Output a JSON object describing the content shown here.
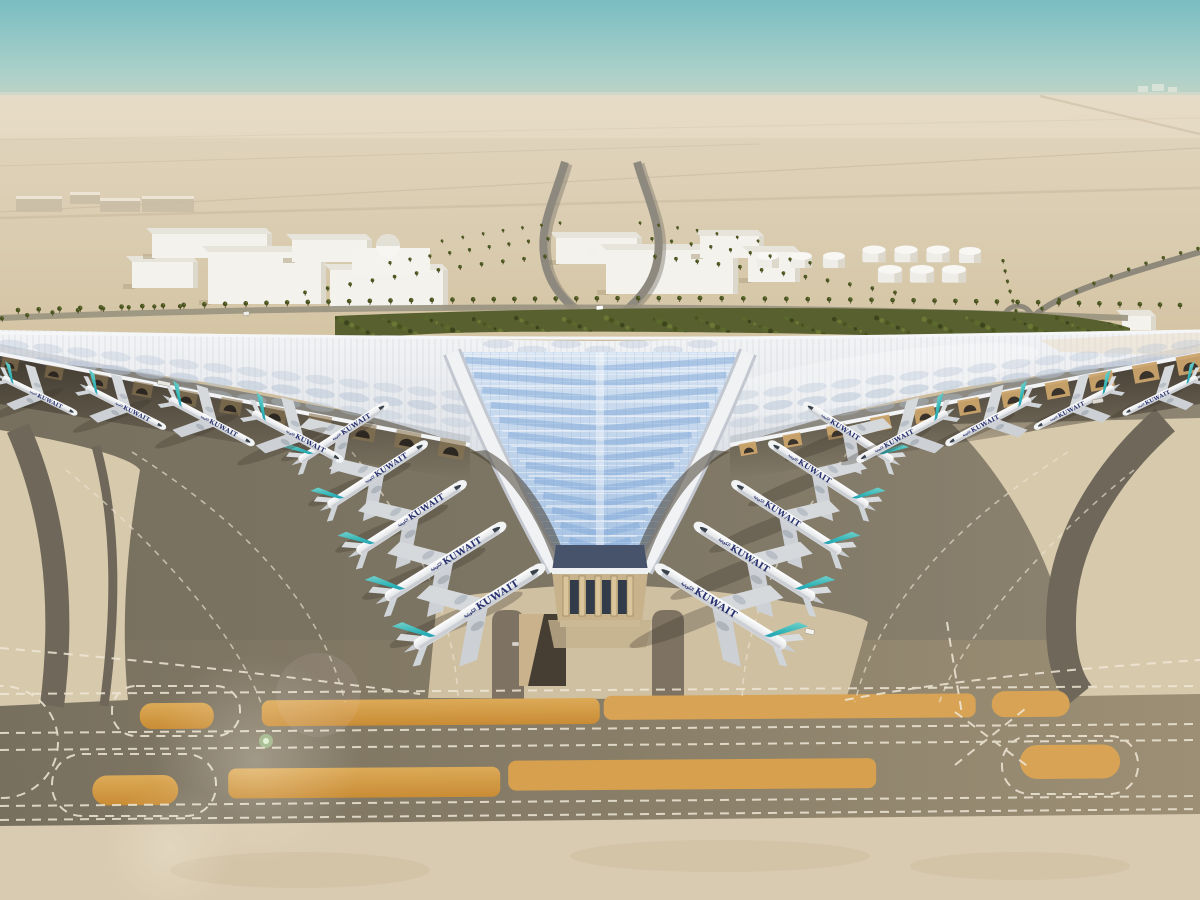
{
  "scene": {
    "title": "Aerial rendering of Kuwait International Airport trefoil terminal",
    "airline": "KUWAIT",
    "airline_arabic": "الكويتية",
    "colors": {
      "sky_top": "#79bdc2",
      "sky_haze": "#ded5c2",
      "desert": "#d5c5a6",
      "apron_dark": "#7b7363",
      "taxiway_paint_orange": "#d29843",
      "concrete_light": "#d8cab0",
      "roof_silver": "#e9ebee",
      "roof_glass_blue": "#aac6e2",
      "green_strip": "#57602e",
      "tail_teal": "#2fb4b4",
      "tail_blue": "#1b74b8",
      "airline_navy": "#26306e"
    },
    "counts": {
      "left_pier_aircraft": 5,
      "right_pier_aircraft": 5,
      "left_wing_aircraft": 4,
      "right_wing_aircraft": 4,
      "fuel_tanks": 10
    },
    "aircraft": [
      {
        "x": 344,
        "y": 432,
        "s": 0.64,
        "rot": -33,
        "m": 0
      },
      {
        "x": 378,
        "y": 474,
        "s": 0.71,
        "rot": -33,
        "m": 0
      },
      {
        "x": 412,
        "y": 517,
        "s": 0.78,
        "rot": -33,
        "m": 0
      },
      {
        "x": 446,
        "y": 561,
        "s": 0.85,
        "rot": -32,
        "m": 0
      },
      {
        "x": 480,
        "y": 606,
        "s": 0.92,
        "rot": -32,
        "m": 0
      },
      {
        "x": 848,
        "y": 432,
        "s": 0.64,
        "rot": 33,
        "m": 1
      },
      {
        "x": 818,
        "y": 474,
        "s": 0.71,
        "rot": 33,
        "m": 1
      },
      {
        "x": 786,
        "y": 517,
        "s": 0.78,
        "rot": 33,
        "m": 1
      },
      {
        "x": 754,
        "y": 561,
        "s": 0.85,
        "rot": 32,
        "m": 1
      },
      {
        "x": 720,
        "y": 606,
        "s": 0.92,
        "rot": 32,
        "m": 1
      },
      {
        "x": 40,
        "y": 396,
        "s": 0.5,
        "rot": 26,
        "m": 0
      },
      {
        "x": 126,
        "y": 408,
        "s": 0.54,
        "rot": 27,
        "m": 0
      },
      {
        "x": 212,
        "y": 422,
        "s": 0.58,
        "rot": 28,
        "m": 0
      },
      {
        "x": 298,
        "y": 437,
        "s": 0.62,
        "rot": 28,
        "m": 0
      },
      {
        "x": 1160,
        "y": 396,
        "s": 0.5,
        "rot": -26,
        "m": 1
      },
      {
        "x": 1074,
        "y": 408,
        "s": 0.54,
        "rot": -27,
        "m": 1
      },
      {
        "x": 988,
        "y": 422,
        "s": 0.58,
        "rot": -28,
        "m": 1
      },
      {
        "x": 902,
        "y": 437,
        "s": 0.62,
        "rot": -28,
        "m": 1
      }
    ],
    "vehicles": [
      {
        "x": 806,
        "y": 628,
        "w": 9,
        "h": 5,
        "r": 14,
        "c": "#f4f2ec"
      },
      {
        "x": 596,
        "y": 306,
        "w": 7,
        "h": 4,
        "r": -6,
        "c": "#ffffff"
      },
      {
        "x": 243,
        "y": 312,
        "w": 6,
        "h": 4,
        "r": -8,
        "c": "#f0eee8"
      },
      {
        "x": 158,
        "y": 380,
        "w": 13,
        "h": 4,
        "r": 12,
        "c": "#e8e6e0"
      },
      {
        "x": 512,
        "y": 642,
        "w": 7,
        "h": 4,
        "r": 0,
        "c": "#d8d4cb"
      },
      {
        "x": 1092,
        "y": 400,
        "w": 11,
        "h": 4,
        "r": -10,
        "c": "#dddbd4"
      }
    ],
    "fuel_tanks": [
      [
        768,
        262,
        1
      ],
      [
        801,
        262,
        1
      ],
      [
        834,
        262,
        1
      ],
      [
        874,
        256,
        1.05
      ],
      [
        906,
        256,
        1.05
      ],
      [
        938,
        256,
        1.05
      ],
      [
        970,
        257,
        1
      ],
      [
        890,
        276,
        1.1
      ],
      [
        922,
        276,
        1.1
      ],
      [
        954,
        276,
        1.1
      ]
    ],
    "buildings": [
      {
        "x": 132,
        "y": 262,
        "w": 66,
        "h": 26
      },
      {
        "x": 152,
        "y": 234,
        "w": 120,
        "h": 24
      },
      {
        "x": 208,
        "y": 252,
        "w": 118,
        "h": 52
      },
      {
        "x": 330,
        "y": 270,
        "w": 118,
        "h": 40
      },
      {
        "x": 292,
        "y": 240,
        "w": 80,
        "h": 22
      },
      {
        "x": 556,
        "y": 238,
        "w": 86,
        "h": 26
      },
      {
        "x": 606,
        "y": 250,
        "w": 132,
        "h": 44
      },
      {
        "x": 700,
        "y": 236,
        "w": 64,
        "h": 22
      },
      {
        "x": 748,
        "y": 252,
        "w": 52,
        "h": 30
      },
      {
        "x": 1122,
        "y": 316,
        "w": 34,
        "h": 14
      }
    ],
    "mosque": {
      "base": [
        352,
        248,
        78,
        26
      ],
      "dome": [
        388,
        246,
        12
      ],
      "small_dome": [
        592,
        250,
        5
      ]
    },
    "palm_rows": [
      {
        "p": [
          [
            18,
            312
          ],
          [
            360,
            300
          ],
          [
            700,
            300
          ]
        ],
        "n": 34,
        "sc": 1
      },
      {
        "p": [
          [
            700,
            300
          ],
          [
            950,
            302
          ],
          [
            1180,
            307
          ]
        ],
        "n": 24,
        "sc": 1
      },
      {
        "p": [
          [
            545,
            258
          ],
          [
            430,
            270
          ],
          [
            305,
            294
          ]
        ],
        "n": 12,
        "sc": 0.8
      },
      {
        "p": [
          [
            548,
            240
          ],
          [
            470,
            250
          ],
          [
            390,
            264
          ]
        ],
        "n": 9,
        "sc": 0.7
      },
      {
        "p": [
          [
            560,
            224
          ],
          [
            505,
            230
          ],
          [
            442,
            242
          ]
        ],
        "n": 7,
        "sc": 0.6
      },
      {
        "p": [
          [
            655,
            258
          ],
          [
            770,
            270
          ],
          [
            895,
            294
          ]
        ],
        "n": 12,
        "sc": 0.8
      },
      {
        "p": [
          [
            652,
            240
          ],
          [
            730,
            250
          ],
          [
            810,
            264
          ]
        ],
        "n": 9,
        "sc": 0.7
      },
      {
        "p": [
          [
            640,
            224
          ],
          [
            695,
            230
          ],
          [
            758,
            242
          ]
        ],
        "n": 7,
        "sc": 0.6
      },
      {
        "p": [
          [
            1198,
            250
          ],
          [
            1120,
            268
          ],
          [
            1042,
            310
          ]
        ],
        "n": 10,
        "sc": 0.75
      },
      {
        "p": [
          [
            1003,
            262
          ],
          [
            1008,
            288
          ],
          [
            1016,
            312
          ]
        ],
        "n": 6,
        "sc": 0.7
      },
      {
        "p": [
          [
            2,
            320
          ],
          [
            90,
            308
          ],
          [
            180,
            308
          ]
        ],
        "n": 8,
        "sc": 0.9
      }
    ],
    "distant_left_blocks": [
      [
        16,
        196,
        46,
        16
      ],
      [
        70,
        192,
        30,
        12
      ],
      [
        100,
        198,
        40,
        14
      ],
      [
        142,
        196,
        52,
        16
      ]
    ],
    "distant_right_blocks": [
      [
        1138,
        86,
        10,
        6
      ],
      [
        1152,
        84,
        12,
        7
      ],
      [
        1168,
        87,
        9,
        5
      ]
    ]
  }
}
